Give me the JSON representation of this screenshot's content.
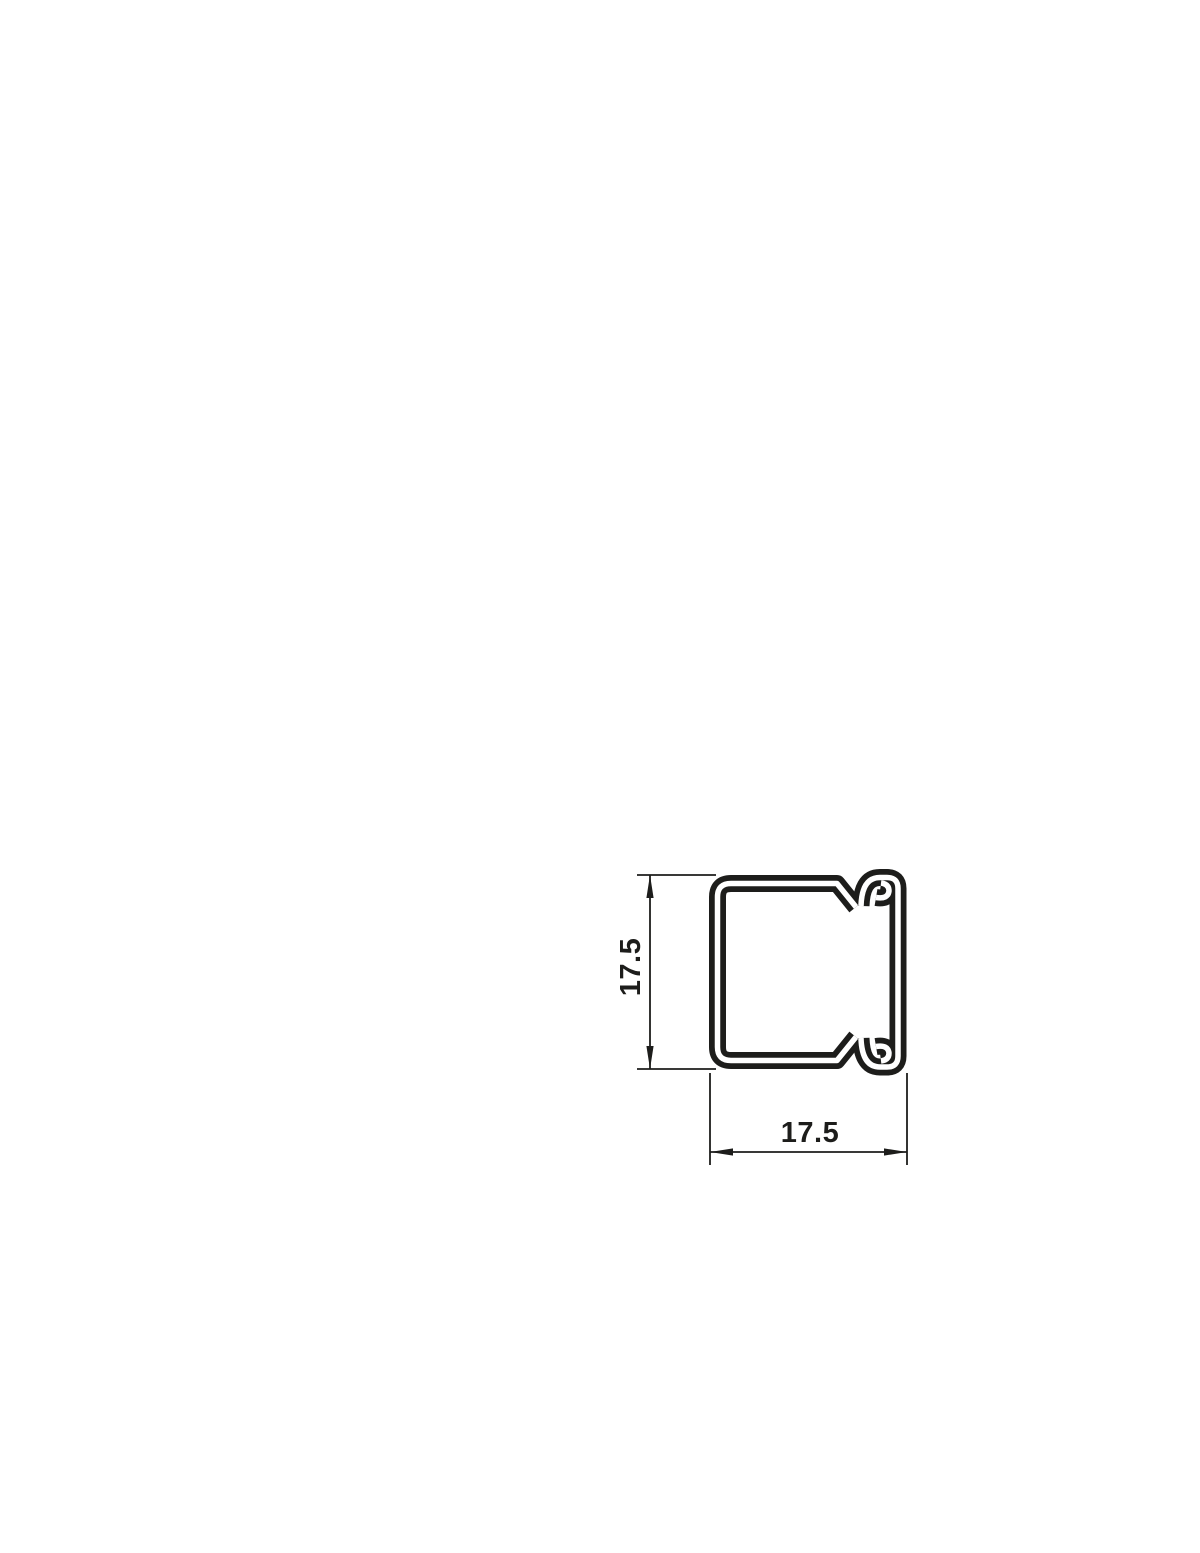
{
  "drawing": {
    "background_color": "#ffffff",
    "line_color": "#1d1d1b",
    "dimensions": {
      "height_label": "17.5",
      "width_label": "17.5"
    }
  }
}
